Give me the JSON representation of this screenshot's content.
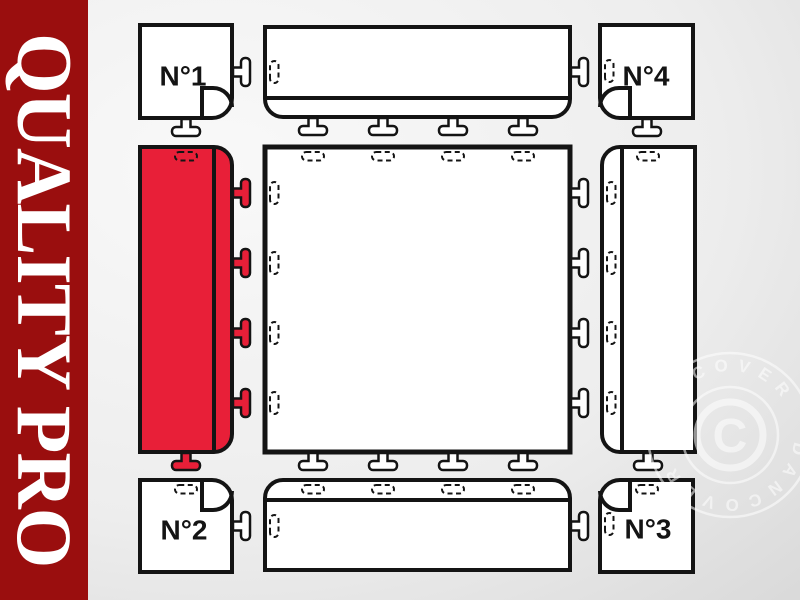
{
  "banner": {
    "text": "QUALITY PRO"
  },
  "colors": {
    "banner-red": "#9a0e0e",
    "highlight-red": "#e81f38",
    "line": "#141414",
    "bg-light": "#f9f9f9",
    "bg-dark": "#d2d2d2"
  },
  "diagram": {
    "corner_labels": [
      "N°1",
      "N°2",
      "N°3",
      "N°4"
    ]
  },
  "watermark": {
    "ring_text": "DANCOVER DANCOVER",
    "center_symbol": "C"
  }
}
